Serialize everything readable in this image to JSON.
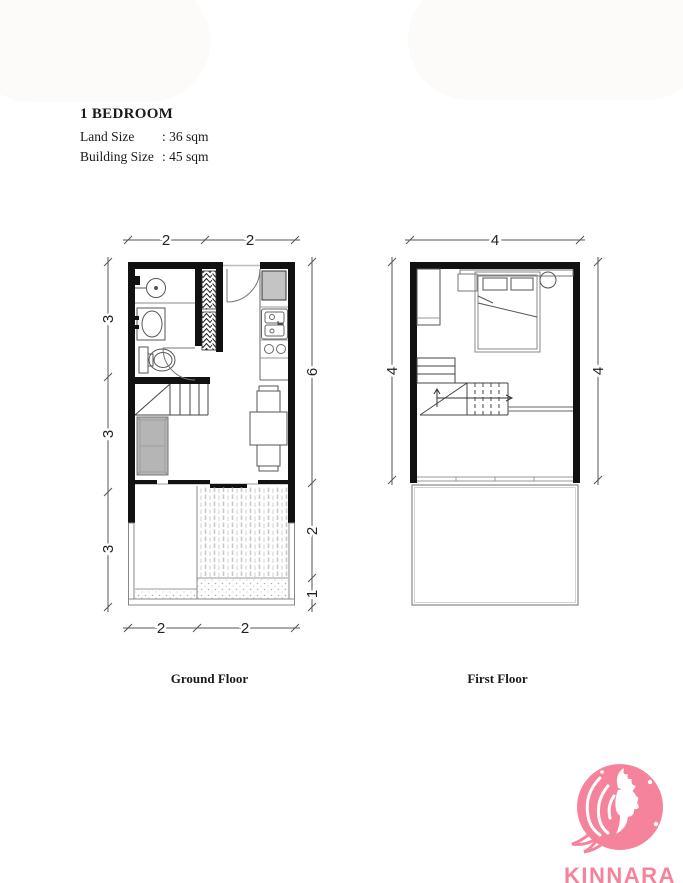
{
  "header": {
    "title": "1 BEDROOM",
    "specs": [
      {
        "label": "Land Size",
        "value": ": 36 sqm"
      },
      {
        "label": "Building Size",
        "value": ": 45 sqm"
      }
    ]
  },
  "plans": {
    "ground": {
      "label": "Ground Floor",
      "dims_top": [
        "2",
        "2"
      ],
      "dims_bottom": [
        "2",
        "2"
      ],
      "dims_left": [
        "3",
        "3",
        "3"
      ],
      "dims_right": [
        "6",
        "2",
        "1"
      ]
    },
    "first": {
      "label": "First Floor",
      "dims_top": [
        "4"
      ],
      "dims_left": [
        "4"
      ],
      "dims_right": [
        "4"
      ]
    }
  },
  "logo": {
    "text": "KINNARA",
    "color": "#f5839b"
  },
  "colors": {
    "wall": "#111111",
    "line": "#555555",
    "logo_pink": "#f5839b"
  }
}
